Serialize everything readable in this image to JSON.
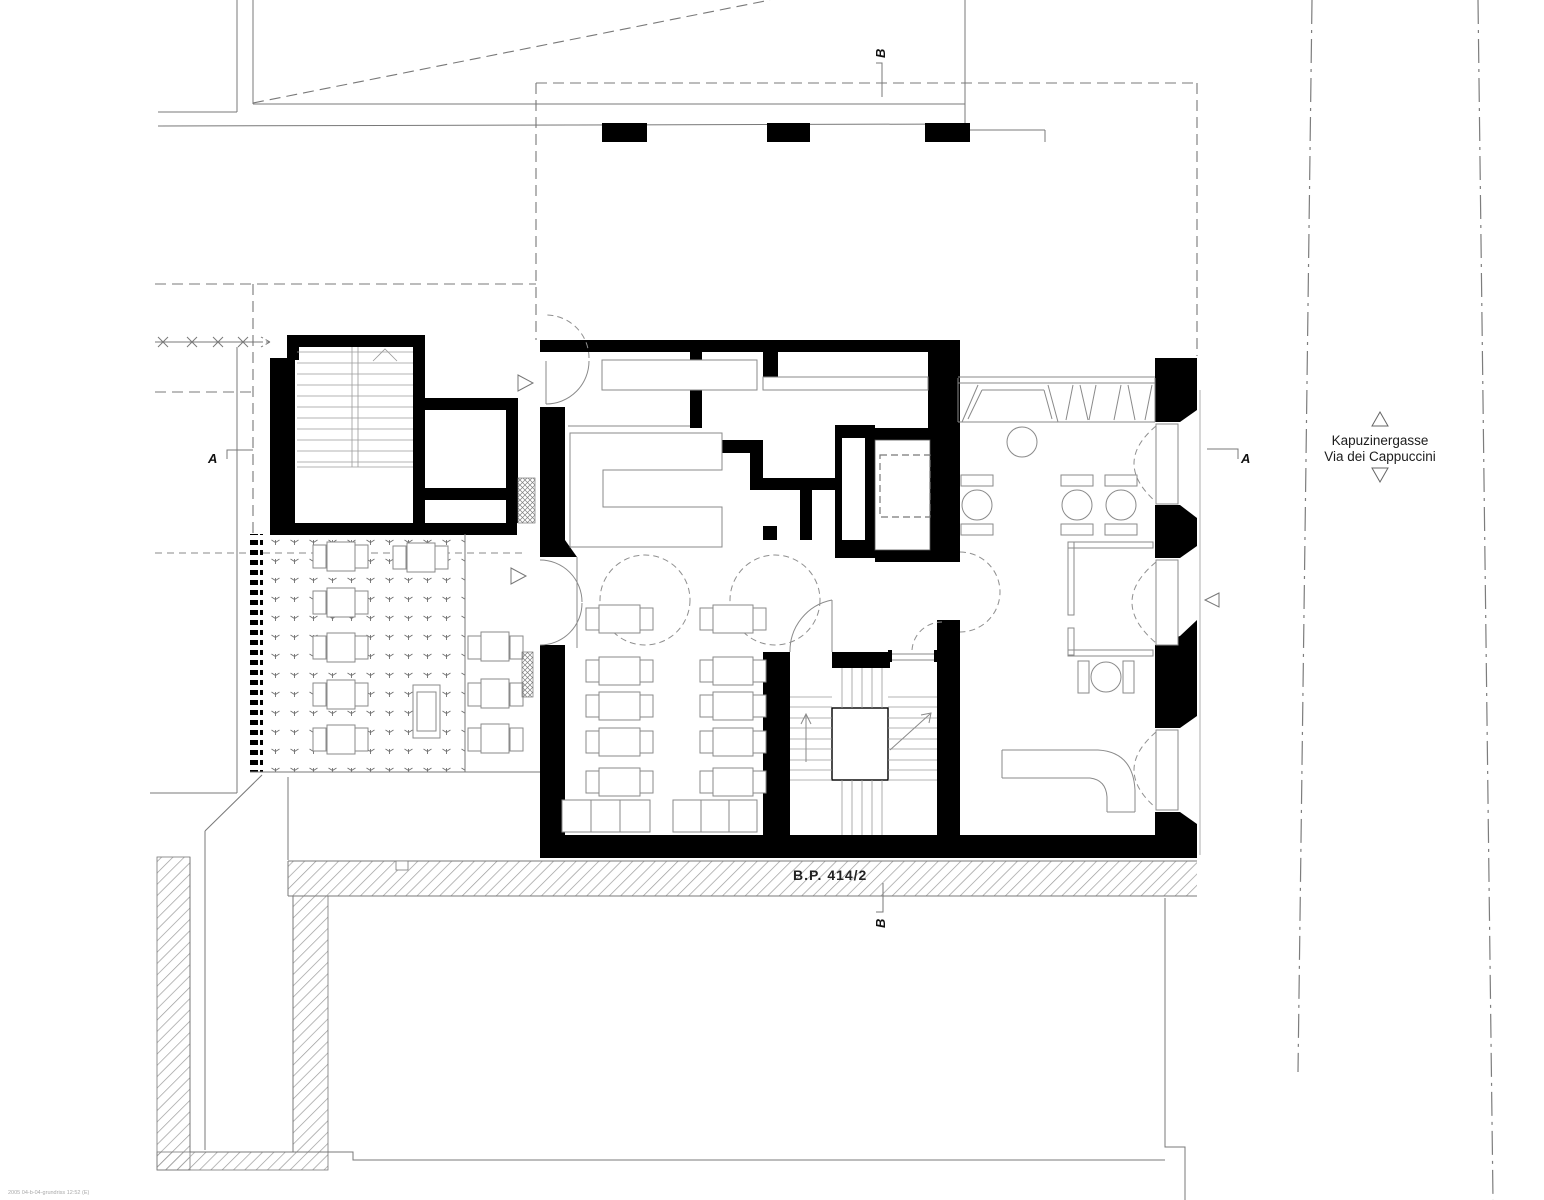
{
  "plan": {
    "street": {
      "line1": "Kapuzinergasse",
      "line2": "Via dei Cappuccini"
    },
    "parcel_label": "B.P. 414/2",
    "markers": {
      "a": "A",
      "b": "B"
    },
    "stamp": "2005 04-b-04-grundriss 12:52 (E)",
    "colors": {
      "wall": "#000000",
      "line": "#787878",
      "hatch_line": "#9b9b9b",
      "text": "#1c1c1c"
    }
  }
}
